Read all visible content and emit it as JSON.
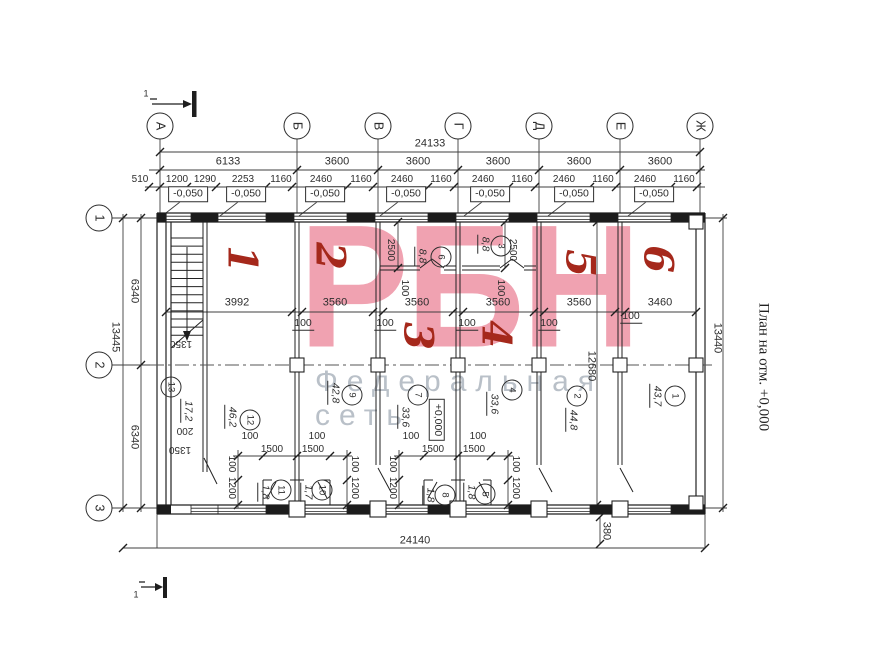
{
  "caption": {
    "side": "План на отм. +0,000"
  },
  "watermark": {
    "main": "РБН",
    "subtitle": "Федеральная сеть",
    "main_color": "#f0a2b1",
    "subtitle_color": "#b9c0c8"
  },
  "axes": {
    "top": [
      "А",
      "Б",
      "В",
      "Г",
      "Д",
      "Е",
      "Ж"
    ],
    "left": [
      "1",
      "2",
      "3"
    ]
  },
  "elevation_marks": {
    "minus": "-0,050",
    "zero": "+0,000"
  },
  "overall_dimensions": {
    "top_total": "24133",
    "bottom_total": "24140",
    "left_total": "13445",
    "right_total": "13440"
  },
  "labels": [
    {
      "t": "24133",
      "x": 430,
      "y": 144,
      "c": "d"
    },
    {
      "t": "6133",
      "x": 228,
      "y": 162,
      "c": "d"
    },
    {
      "t": "3600",
      "x": 337,
      "y": 162,
      "c": "d"
    },
    {
      "t": "3600",
      "x": 418,
      "y": 162,
      "c": "d"
    },
    {
      "t": "3600",
      "x": 498,
      "y": 162,
      "c": "d"
    },
    {
      "t": "3600",
      "x": 579,
      "y": 162,
      "c": "d"
    },
    {
      "t": "3600",
      "x": 660,
      "y": 162,
      "c": "d"
    },
    {
      "t": "510",
      "x": 140,
      "y": 180,
      "c": "d10"
    },
    {
      "t": "1200",
      "x": 177,
      "y": 180,
      "c": "d10"
    },
    {
      "t": "1290",
      "x": 205,
      "y": 180,
      "c": "d10"
    },
    {
      "t": "2253",
      "x": 243,
      "y": 180,
      "c": "d10"
    },
    {
      "t": "1160",
      "x": 281,
      "y": 180,
      "c": "d10"
    },
    {
      "t": "2460",
      "x": 321,
      "y": 180,
      "c": "d10"
    },
    {
      "t": "1160",
      "x": 361,
      "y": 180,
      "c": "d10"
    },
    {
      "t": "2460",
      "x": 402,
      "y": 180,
      "c": "d10"
    },
    {
      "t": "1160",
      "x": 441,
      "y": 180,
      "c": "d10"
    },
    {
      "t": "2460",
      "x": 483,
      "y": 180,
      "c": "d10"
    },
    {
      "t": "1160",
      "x": 522,
      "y": 180,
      "c": "d10"
    },
    {
      "t": "2460",
      "x": 564,
      "y": 180,
      "c": "d10"
    },
    {
      "t": "1160",
      "x": 603,
      "y": 180,
      "c": "d10"
    },
    {
      "t": "2460",
      "x": 645,
      "y": 180,
      "c": "d10"
    },
    {
      "t": "1160",
      "x": 684,
      "y": 180,
      "c": "d10"
    },
    {
      "t": "-0,050",
      "x": 188,
      "y": 194,
      "c": "ev"
    },
    {
      "t": "-0,050",
      "x": 246,
      "y": 194,
      "c": "ev"
    },
    {
      "t": "-0,050",
      "x": 325,
      "y": 194,
      "c": "ev"
    },
    {
      "t": "-0,050",
      "x": 406,
      "y": 194,
      "c": "ev"
    },
    {
      "t": "-0,050",
      "x": 490,
      "y": 194,
      "c": "ev"
    },
    {
      "t": "-0,050",
      "x": 574,
      "y": 194,
      "c": "ev"
    },
    {
      "t": "-0,050",
      "x": 654,
      "y": 194,
      "c": "ev"
    },
    {
      "t": "+0,000",
      "x": 437,
      "y": 420,
      "c": "evv"
    },
    {
      "t": "А",
      "x": 160,
      "y": 126,
      "c": "bub"
    },
    {
      "t": "Б",
      "x": 297,
      "y": 126,
      "c": "bub"
    },
    {
      "t": "В",
      "x": 378,
      "y": 126,
      "c": "bub"
    },
    {
      "t": "Г",
      "x": 458,
      "y": 126,
      "c": "bub"
    },
    {
      "t": "Д",
      "x": 539,
      "y": 126,
      "c": "bub"
    },
    {
      "t": "Е",
      "x": 620,
      "y": 126,
      "c": "bub"
    },
    {
      "t": "Ж",
      "x": 700,
      "y": 126,
      "c": "bub"
    },
    {
      "t": "1",
      "x": 99,
      "y": 218,
      "c": "bub"
    },
    {
      "t": "2",
      "x": 99,
      "y": 365,
      "c": "bub"
    },
    {
      "t": "3",
      "x": 99,
      "y": 508,
      "c": "bub"
    },
    {
      "t": "13445",
      "x": 115,
      "y": 337,
      "c": "dv"
    },
    {
      "t": "6340",
      "x": 134,
      "y": 291,
      "c": "dv"
    },
    {
      "t": "6340",
      "x": 134,
      "y": 437,
      "c": "dv"
    },
    {
      "t": "13440",
      "x": 717,
      "y": 338,
      "c": "dv"
    },
    {
      "t": "12680",
      "x": 591,
      "y": 366,
      "c": "dv"
    },
    {
      "t": "380",
      "x": 606,
      "y": 531,
      "c": "dv"
    },
    {
      "t": "24140",
      "x": 415,
      "y": 541,
      "c": "d"
    },
    {
      "t": "3992",
      "x": 237,
      "y": 303,
      "c": "d"
    },
    {
      "t": "3560",
      "x": 335,
      "y": 303,
      "c": "d"
    },
    {
      "t": "3560",
      "x": 417,
      "y": 303,
      "c": "d"
    },
    {
      "t": "3560",
      "x": 498,
      "y": 303,
      "c": "d"
    },
    {
      "t": "3560",
      "x": 579,
      "y": 303,
      "c": "d"
    },
    {
      "t": "3460",
      "x": 660,
      "y": 303,
      "c": "d"
    },
    {
      "t": "100",
      "x": 303,
      "y": 324,
      "c": "du"
    },
    {
      "t": "100",
      "x": 385,
      "y": 324,
      "c": "du"
    },
    {
      "t": "100",
      "x": 467,
      "y": 324,
      "c": "du"
    },
    {
      "t": "100",
      "x": 549,
      "y": 324,
      "c": "du"
    },
    {
      "t": "100",
      "x": 631,
      "y": 317,
      "c": "du"
    },
    {
      "t": "2500",
      "x": 390,
      "y": 250,
      "c": "dv10"
    },
    {
      "t": "2500",
      "x": 512,
      "y": 250,
      "c": "dv10"
    },
    {
      "t": "100",
      "x": 404,
      "y": 288,
      "c": "dv10"
    },
    {
      "t": "100",
      "x": 500,
      "y": 288,
      "c": "dv10"
    },
    {
      "t": "8,8",
      "x": 421,
      "y": 256,
      "c": "a"
    },
    {
      "t": "8,8",
      "x": 484,
      "y": 244,
      "c": "a"
    },
    {
      "t": "6",
      "x": 441,
      "y": 257,
      "c": "rc"
    },
    {
      "t": "3",
      "x": 501,
      "y": 246,
      "c": "rc"
    },
    {
      "t": "1350",
      "x": 181,
      "y": 343,
      "c": "df"
    },
    {
      "t": "200",
      "x": 185,
      "y": 430,
      "c": "df"
    },
    {
      "t": "1350",
      "x": 180,
      "y": 449,
      "c": "df"
    },
    {
      "t": "13",
      "x": 171,
      "y": 387,
      "c": "rc"
    },
    {
      "t": "17,2",
      "x": 187,
      "y": 411,
      "c": "a"
    },
    {
      "t": "12",
      "x": 250,
      "y": 420,
      "c": "rc"
    },
    {
      "t": "46,2",
      "x": 231,
      "y": 417,
      "c": "a"
    },
    {
      "t": "9",
      "x": 352,
      "y": 395,
      "c": "rc"
    },
    {
      "t": "42,8",
      "x": 334,
      "y": 393,
      "c": "a"
    },
    {
      "t": "7",
      "x": 418,
      "y": 395,
      "c": "rc"
    },
    {
      "t": "33,6",
      "x": 404,
      "y": 417,
      "c": "a"
    },
    {
      "t": "4",
      "x": 512,
      "y": 390,
      "c": "rc"
    },
    {
      "t": "33,6",
      "x": 493,
      "y": 404,
      "c": "a"
    },
    {
      "t": "2",
      "x": 577,
      "y": 396,
      "c": "rc"
    },
    {
      "t": "44,8",
      "x": 572,
      "y": 420,
      "c": "a"
    },
    {
      "t": "1",
      "x": 675,
      "y": 396,
      "c": "rc"
    },
    {
      "t": "43,7",
      "x": 656,
      "y": 396,
      "c": "a"
    },
    {
      "t": "11",
      "x": 281,
      "y": 490,
      "c": "rc"
    },
    {
      "t": "1,8",
      "x": 264,
      "y": 492,
      "c": "a"
    },
    {
      "t": "10",
      "x": 322,
      "y": 490,
      "c": "rc"
    },
    {
      "t": "1,7",
      "x": 307,
      "y": 492,
      "c": "a"
    },
    {
      "t": "8",
      "x": 445,
      "y": 495,
      "c": "rc"
    },
    {
      "t": "1,8",
      "x": 429,
      "y": 495,
      "c": "a"
    },
    {
      "t": "5",
      "x": 485,
      "y": 494,
      "c": "rc"
    },
    {
      "t": "1,8",
      "x": 470,
      "y": 492,
      "c": "a"
    },
    {
      "t": "100",
      "x": 250,
      "y": 437,
      "c": "d10"
    },
    {
      "t": "100",
      "x": 317,
      "y": 437,
      "c": "d10"
    },
    {
      "t": "1500",
      "x": 272,
      "y": 450,
      "c": "d10"
    },
    {
      "t": "1500",
      "x": 313,
      "y": 450,
      "c": "d10"
    },
    {
      "t": "100",
      "x": 231,
      "y": 464,
      "c": "dv10"
    },
    {
      "t": "1200",
      "x": 231,
      "y": 488,
      "c": "dv10"
    },
    {
      "t": "100",
      "x": 354,
      "y": 464,
      "c": "dv10"
    },
    {
      "t": "1200",
      "x": 354,
      "y": 488,
      "c": "dv10"
    },
    {
      "t": "100",
      "x": 411,
      "y": 437,
      "c": "d10"
    },
    {
      "t": "100",
      "x": 478,
      "y": 437,
      "c": "d10"
    },
    {
      "t": "1500",
      "x": 433,
      "y": 450,
      "c": "d10"
    },
    {
      "t": "1500",
      "x": 474,
      "y": 450,
      "c": "d10"
    },
    {
      "t": "100",
      "x": 392,
      "y": 464,
      "c": "dv10"
    },
    {
      "t": "1200",
      "x": 392,
      "y": 488,
      "c": "dv10"
    },
    {
      "t": "100",
      "x": 515,
      "y": 464,
      "c": "dv10"
    },
    {
      "t": "1200",
      "x": 515,
      "y": 488,
      "c": "dv10"
    },
    {
      "t": "1",
      "x": 146,
      "y": 94,
      "c": "s1"
    },
    {
      "t": "1",
      "x": 136,
      "y": 595,
      "c": "s1"
    },
    {
      "t": "1",
      "x": 242,
      "y": 259,
      "c": "red"
    },
    {
      "t": "2",
      "x": 330,
      "y": 256,
      "c": "red"
    },
    {
      "t": "3",
      "x": 418,
      "y": 336,
      "c": "red"
    },
    {
      "t": "4",
      "x": 496,
      "y": 334,
      "c": "red"
    },
    {
      "t": "5",
      "x": 580,
      "y": 263,
      "c": "red"
    },
    {
      "t": "6",
      "x": 658,
      "y": 259,
      "c": "red"
    }
  ]
}
